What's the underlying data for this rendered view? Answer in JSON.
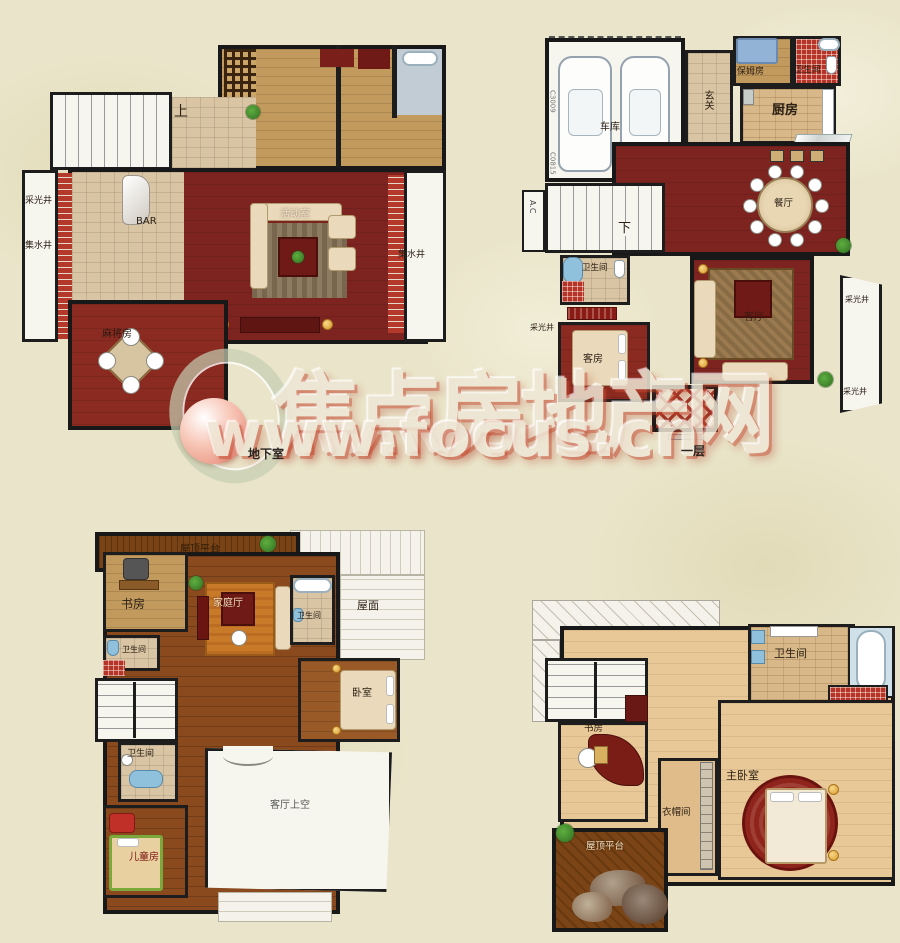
{
  "palette": {
    "bg": "#eae5ca",
    "wall": "#1d1d1d",
    "floor_red": "#7d2420",
    "tile_tan": "#d9c5a3",
    "wood_mid": "#c39a5d",
    "wood_dark": "#8a4a1e",
    "tan_light": "#e9c897",
    "white_area": "#f6f5ee",
    "brick_red": "#b5392a",
    "mosaic_red": "#b43528",
    "blue_fixture": "#8fc1dd",
    "plant_green": "#3f8f2f",
    "rug_orange": "#c87a28",
    "gold": "#e0aa3e",
    "wm_cream": "#efe7d6",
    "wm_red": "#c84a34"
  },
  "watermark": {
    "brand": "焦点房地产网",
    "url": "www.focus.cn",
    "logo": "focus-sphere-logo"
  },
  "plans": {
    "basement": {
      "caption": "地下室",
      "rooms": {
        "stairs": "上",
        "light_well": "采光井",
        "sump_left": "集水井",
        "bar": "BAR",
        "activity": "活动室",
        "mahjong": "麻将房",
        "sump_right": "集水井"
      }
    },
    "floor1": {
      "caption": "一层",
      "rooms": {
        "garage": "车库",
        "entry": "玄关",
        "nanny": "保姆房",
        "bath_top": "卫生间",
        "kitchen": "厨房",
        "dining": "餐厅",
        "stairs": "下",
        "ac": "A.C",
        "bath_mid": "卫生间",
        "guest": "客房",
        "living": "客厅",
        "light_well_left": "采光井",
        "light_well_right": "采光井",
        "light_well_right2": "采光井",
        "code_upper": "C3009",
        "code_lower": "C0815"
      }
    },
    "floor2": {
      "rooms": {
        "terrace": "屋顶平台",
        "study": "书房",
        "family": "家庭厅",
        "bath_left": "卫生间",
        "bath_right": "卫生间",
        "roof": "屋面",
        "bedroom": "卧室",
        "bath_lower": "卫生间",
        "children": "儿童房",
        "void": "客厅上空"
      }
    },
    "floor3": {
      "rooms": {
        "bath": "卫生间",
        "study": "书房",
        "master": "主卧室",
        "closet": "衣帽间",
        "terrace": "屋顶平台"
      }
    }
  }
}
